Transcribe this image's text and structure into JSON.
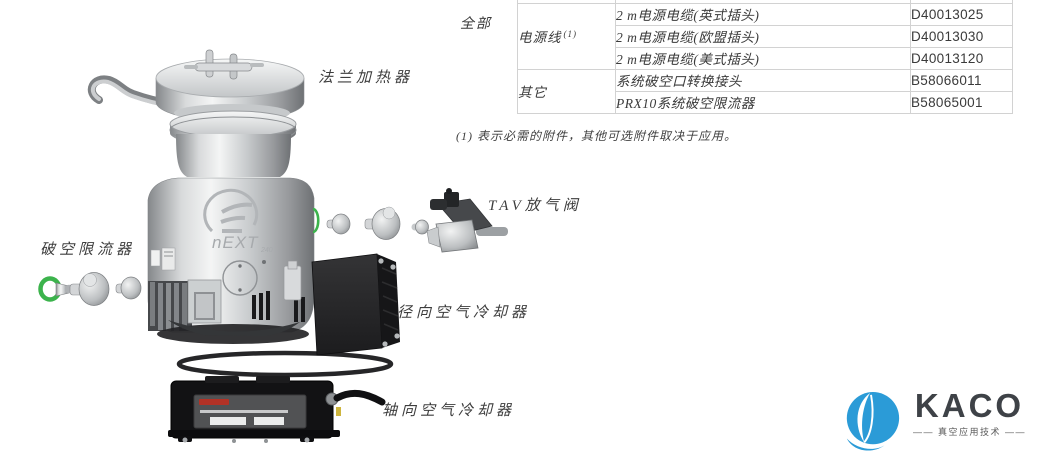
{
  "diagram": {
    "labels": {
      "flange_heater": "法兰加热器",
      "tav_valve": "TAV放气阀",
      "vent_restrictor": "破空限流器",
      "radial_cooler": "径向空气冷却器",
      "axial_cooler": "轴向空气冷却器"
    },
    "pump_model": "nEXT",
    "pump_model_suffix": "240",
    "oring_color": "#3cb34c"
  },
  "table": {
    "row_group_label": "全部",
    "groups": [
      {
        "label": "电源线",
        "sup": "(1)"
      },
      {
        "label": "其它"
      }
    ],
    "rows": [
      {
        "desc": "2 m电源电缆(英式插头)",
        "part": "D40013025"
      },
      {
        "desc": "2 m电源电缆(欧盟插头)",
        "part": "D40013030"
      },
      {
        "desc": "2 m电源电缆(美式插头)",
        "part": "D40013120"
      },
      {
        "desc": "系统破空口转换接头",
        "part": "B58066011"
      },
      {
        "desc": "PRX10系统破空限流器",
        "part": "B58065001"
      }
    ],
    "footnote": "(1) 表示必需的附件，其他可选附件取决于应用。"
  },
  "branding": {
    "name": "KACO",
    "tagline": "—— 真空应用技术 ——",
    "logo_color": "#2b9bd7"
  }
}
